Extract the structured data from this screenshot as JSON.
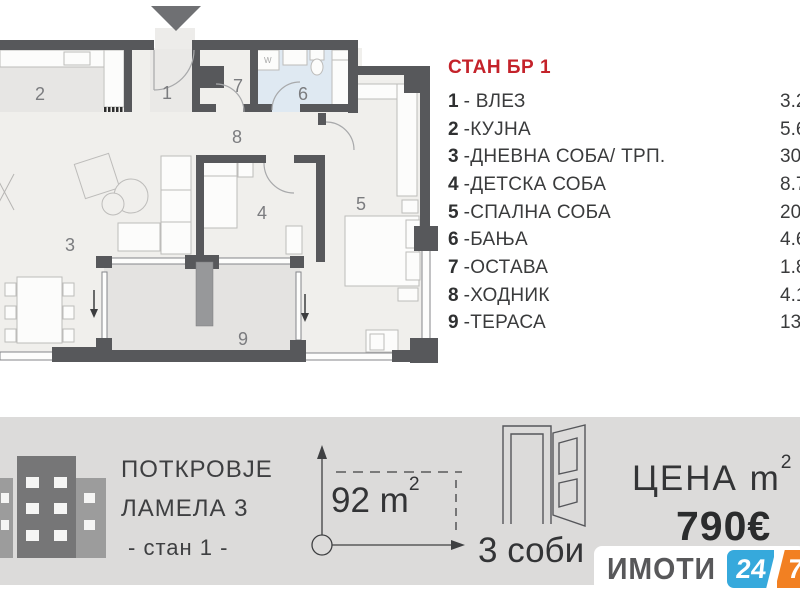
{
  "theme": {
    "title_red": "#c4222a",
    "wall_gray": "#57585b",
    "bathroom_floor": "#dfe9f2",
    "terrace_floor": "#e4e3e1",
    "footer_bg": "#dcdbda",
    "logo_blue": "#36a9dc",
    "logo_orange": "#f28022"
  },
  "apartment": {
    "title": "СТАН БР 1",
    "rooms": [
      {
        "num": "1",
        "name": "- ВЛЕЗ",
        "area": "3.20"
      },
      {
        "num": "2",
        "name": "-КУЈНА",
        "area": "5.60"
      },
      {
        "num": "3",
        "name": "-ДНЕВНА СОБА/ ТРП.",
        "area": "30.0"
      },
      {
        "num": "4",
        "name": "-ДЕТСКА СОБА",
        "area": "8.70"
      },
      {
        "num": "5",
        "name": "-СПАЛНА СОБА",
        "area": "20.7"
      },
      {
        "num": "6",
        "name": "-БАЊА",
        "area": "4.60"
      },
      {
        "num": "7",
        "name": "-ОСТАВА",
        "area": "1.80"
      },
      {
        "num": "8",
        "name": "-ХОДНИК",
        "area": "4.10"
      },
      {
        "num": "9",
        "name": "-ТЕРАСА",
        "area": "13.3"
      }
    ]
  },
  "plan": {
    "labels": [
      "1",
      "2",
      "3",
      "4",
      "5",
      "6",
      "7",
      "8",
      "9"
    ],
    "washer_label": "W"
  },
  "footer": {
    "project_line1": "ПОТКРОВЈЕ",
    "project_line2": "ЛАМЕЛА 3",
    "project_line3": "- стан 1 -",
    "area_value": "92 m",
    "area_sup": "2",
    "rooms_count": "3 соби",
    "price_label": "ЦЕНА m",
    "price_sup": "2",
    "price_value": "790€"
  },
  "logo": {
    "brand": "ИМОТИ",
    "badge_left": "24",
    "badge_right": "7"
  }
}
